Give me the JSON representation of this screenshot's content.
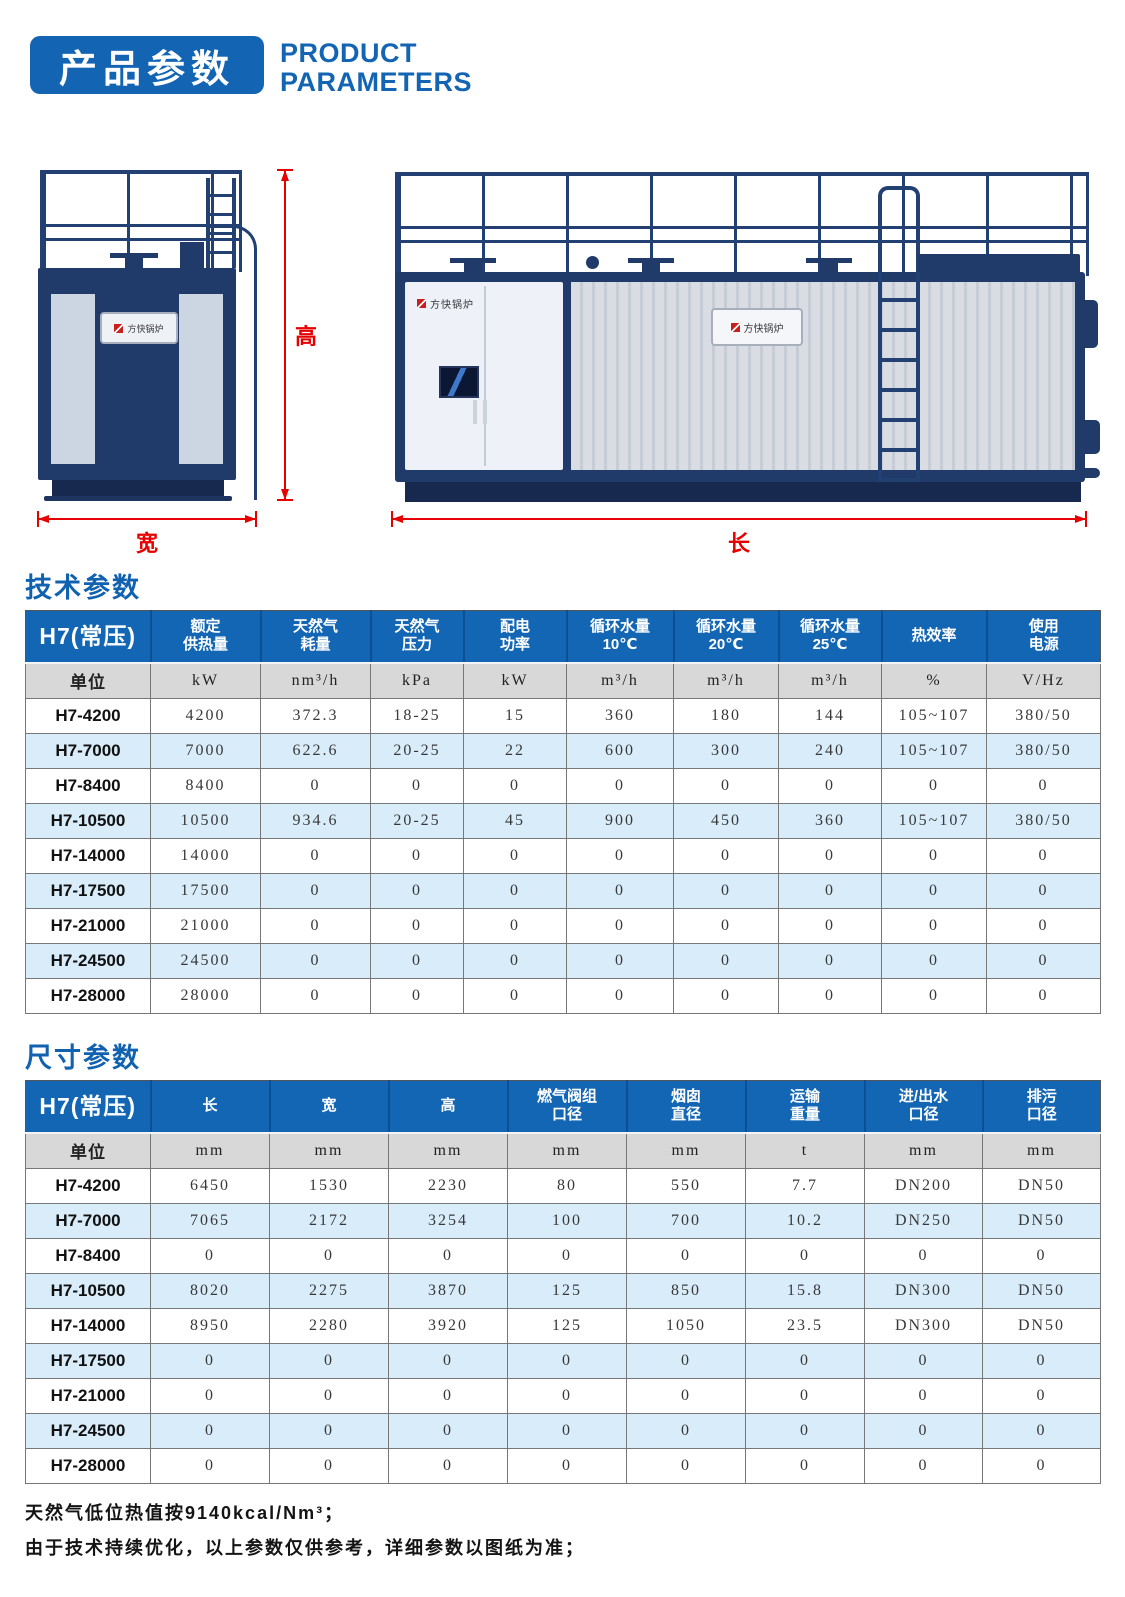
{
  "header": {
    "badge": "产品参数",
    "subtitle": "PRODUCT\nPARAMETERS"
  },
  "diagram": {
    "brand": "方快锅炉",
    "height_label": "高",
    "width_label": "宽",
    "length_label": "长"
  },
  "sections": {
    "tech_title": "技术参数",
    "dim_title": "尺寸参数"
  },
  "tables": {
    "tech": {
      "corner": "H7(常压)",
      "unit_label": "单位",
      "headers": [
        "额定\n供热量",
        "天然气\n耗量",
        "天然气\n压力",
        "配电\n功率",
        "循环水量\n10℃",
        "循环水量\n20℃",
        "循环水量\n25℃",
        "热效率",
        "使用\n电源"
      ],
      "units": [
        "kW",
        "nm³/h",
        "kPa",
        "kW",
        "m³/h",
        "m³/h",
        "m³/h",
        "%",
        "V/Hz"
      ],
      "rows": [
        {
          "label": "H7-4200",
          "values": [
            "4200",
            "372.3",
            "18-25",
            "15",
            "360",
            "180",
            "144",
            "105~107",
            "380/50"
          ]
        },
        {
          "label": "H7-7000",
          "values": [
            "7000",
            "622.6",
            "20-25",
            "22",
            "600",
            "300",
            "240",
            "105~107",
            "380/50"
          ]
        },
        {
          "label": "H7-8400",
          "values": [
            "8400",
            "0",
            "0",
            "0",
            "0",
            "0",
            "0",
            "0",
            "0"
          ]
        },
        {
          "label": "H7-10500",
          "values": [
            "10500",
            "934.6",
            "20-25",
            "45",
            "900",
            "450",
            "360",
            "105~107",
            "380/50"
          ]
        },
        {
          "label": "H7-14000",
          "values": [
            "14000",
            "0",
            "0",
            "0",
            "0",
            "0",
            "0",
            "0",
            "0"
          ]
        },
        {
          "label": "H7-17500",
          "values": [
            "17500",
            "0",
            "0",
            "0",
            "0",
            "0",
            "0",
            "0",
            "0"
          ]
        },
        {
          "label": "H7-21000",
          "values": [
            "21000",
            "0",
            "0",
            "0",
            "0",
            "0",
            "0",
            "0",
            "0"
          ]
        },
        {
          "label": "H7-24500",
          "values": [
            "24500",
            "0",
            "0",
            "0",
            "0",
            "0",
            "0",
            "0",
            "0"
          ]
        },
        {
          "label": "H7-28000",
          "values": [
            "28000",
            "0",
            "0",
            "0",
            "0",
            "0",
            "0",
            "0",
            "0"
          ]
        }
      ]
    },
    "dim": {
      "corner": "H7(常压)",
      "unit_label": "单位",
      "headers": [
        "长",
        "宽",
        "高",
        "燃气阀组\n口径",
        "烟囱\n直径",
        "运输\n重量",
        "进/出水\n口径",
        "排污\n口径"
      ],
      "units": [
        "mm",
        "mm",
        "mm",
        "mm",
        "mm",
        "t",
        "mm",
        "mm"
      ],
      "rows": [
        {
          "label": "H7-4200",
          "values": [
            "6450",
            "1530",
            "2230",
            "80",
            "550",
            "7.7",
            "DN200",
            "DN50"
          ]
        },
        {
          "label": "H7-7000",
          "values": [
            "7065",
            "2172",
            "3254",
            "100",
            "700",
            "10.2",
            "DN250",
            "DN50"
          ]
        },
        {
          "label": "H7-8400",
          "values": [
            "0",
            "0",
            "0",
            "0",
            "0",
            "0",
            "0",
            "0"
          ]
        },
        {
          "label": "H7-10500",
          "values": [
            "8020",
            "2275",
            "3870",
            "125",
            "850",
            "15.8",
            "DN300",
            "DN50"
          ]
        },
        {
          "label": "H7-14000",
          "values": [
            "8950",
            "2280",
            "3920",
            "125",
            "1050",
            "23.5",
            "DN300",
            "DN50"
          ]
        },
        {
          "label": "H7-17500",
          "values": [
            "0",
            "0",
            "0",
            "0",
            "0",
            "0",
            "0",
            "0"
          ]
        },
        {
          "label": "H7-21000",
          "values": [
            "0",
            "0",
            "0",
            "0",
            "0",
            "0",
            "0",
            "0"
          ]
        },
        {
          "label": "H7-24500",
          "values": [
            "0",
            "0",
            "0",
            "0",
            "0",
            "0",
            "0",
            "0"
          ]
        },
        {
          "label": "H7-28000",
          "values": [
            "0",
            "0",
            "0",
            "0",
            "0",
            "0",
            "0",
            "0"
          ]
        }
      ]
    }
  },
  "notes": {
    "line1": "天然气低位热值按9140kcal/Nm³；",
    "line2": "由于技术持续优化，以上参数仅供参考，详细参数以图纸为准；"
  },
  "colors": {
    "primary_blue": "#1365b4",
    "header_separator_blue": "#0d4f93",
    "row_alt_blue": "#d8ecf9",
    "unit_row_gray": "#d8d8d8",
    "boiler_navy": "#203a69",
    "dimension_red": "#e60000",
    "brand_red": "#c8201d"
  }
}
